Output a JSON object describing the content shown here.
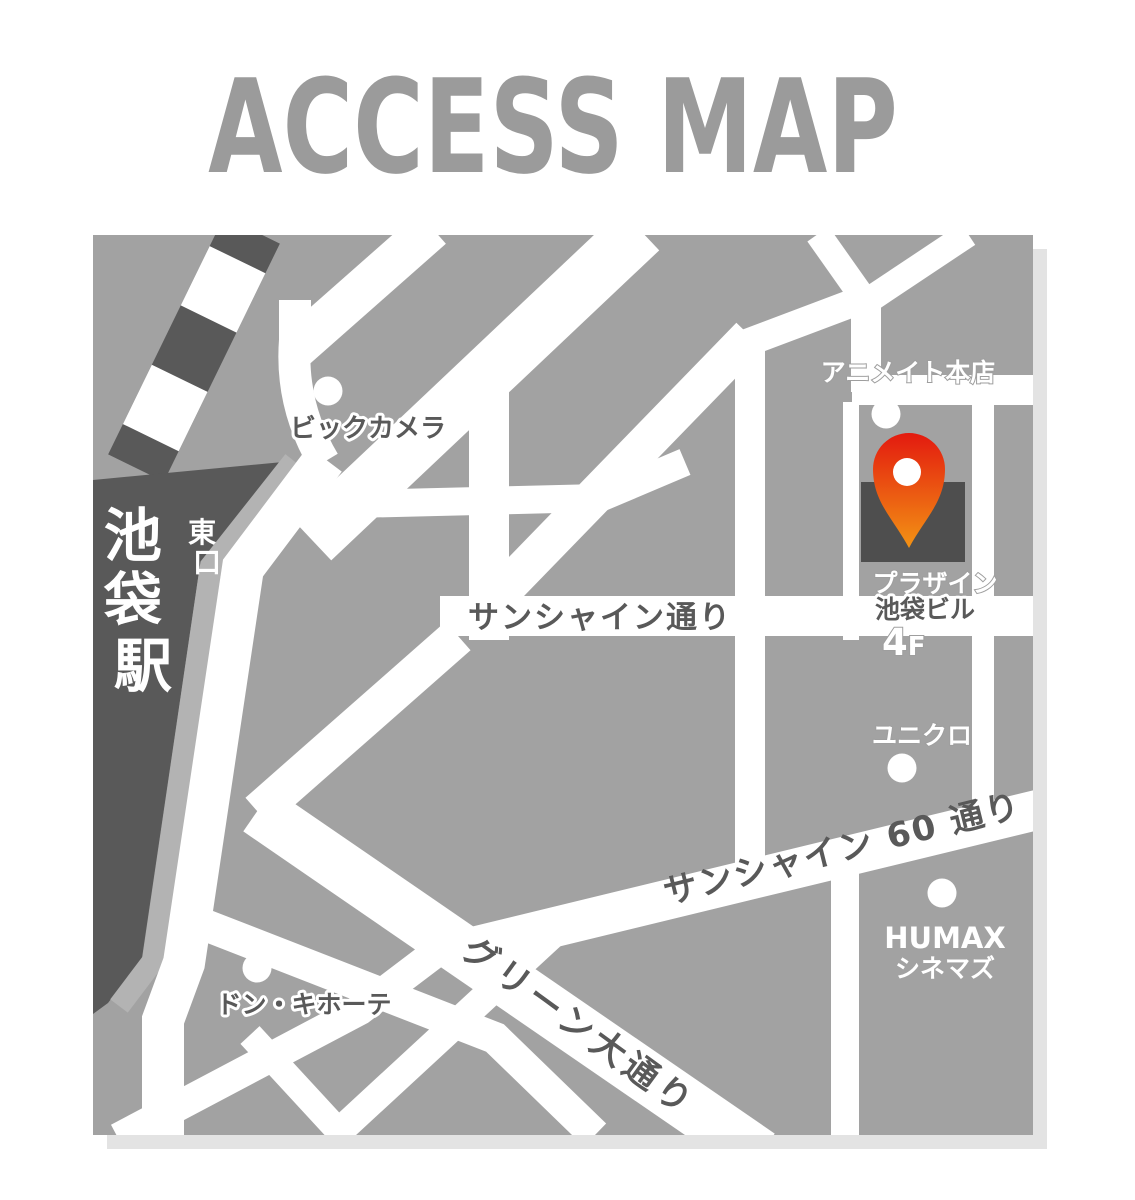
{
  "title": "ACCESS MAP",
  "colors": {
    "title_gray": "#9b9b9b",
    "map_bg": "#a2a2a2",
    "dark": "#595959",
    "road": "#ffffff",
    "shadow": "#e3e3e3",
    "light_strip": "#b3b3b3",
    "building": "#4e4e4e",
    "pin_top": "#e31a0f",
    "pin_bottom": "#f39314"
  },
  "station": {
    "name": "池袋駅",
    "name_chars": [
      "池",
      "袋",
      "駅"
    ],
    "exit": "東口",
    "exit_chars": [
      "東",
      "口"
    ]
  },
  "destination": {
    "line1": "プラザイン",
    "line2": "池袋ビル",
    "floor_number": "4",
    "floor_suffix": "F"
  },
  "streets": {
    "sunshine": "サンシャイン通り",
    "sunshine60": "サンシャイン 60 通り",
    "green": "グリーン大通り"
  },
  "landmarks": {
    "bic_camera": "ビックカメラ",
    "animate": "アニメイト本店",
    "uniqlo": "ユニクロ",
    "humax_line1": "HUMAX",
    "humax_line2": "シネマズ",
    "donki": "ドン・キホーテ"
  }
}
